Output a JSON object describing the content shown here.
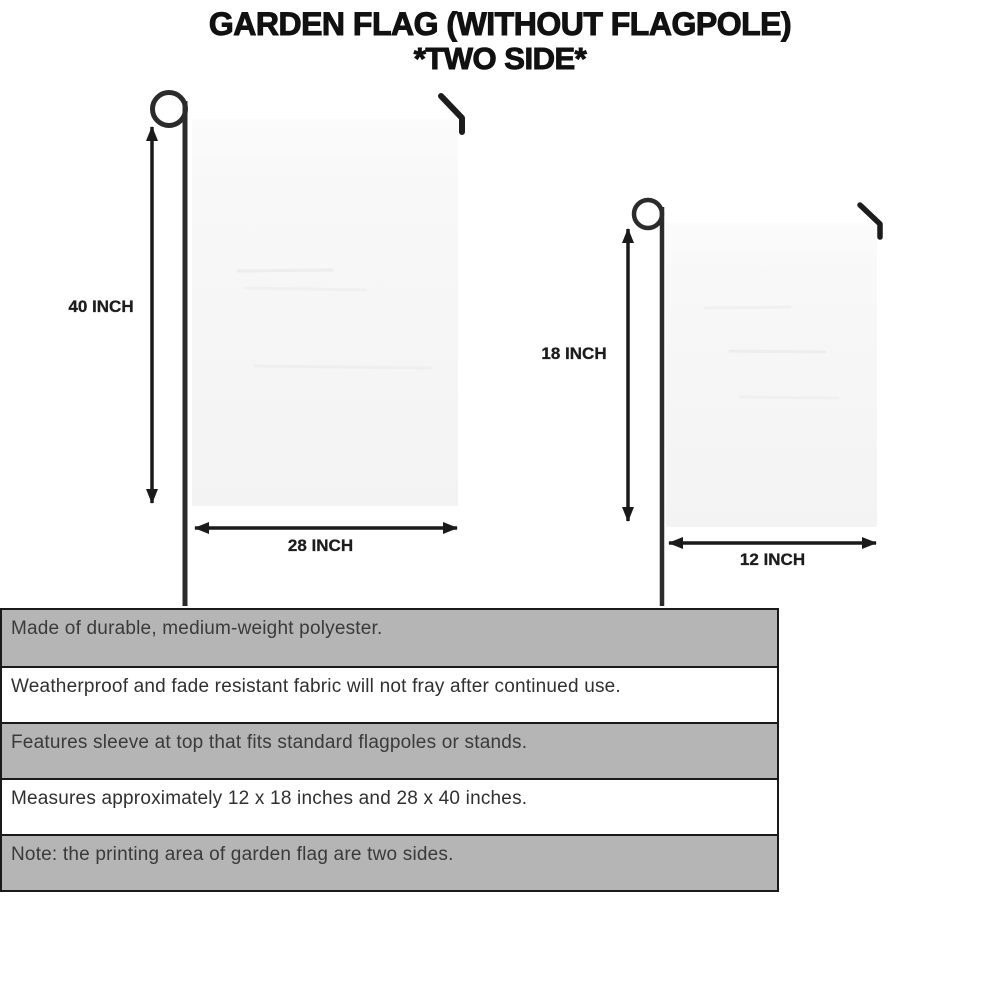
{
  "title": {
    "line1": "GARDEN FLAG (WITHOUT FLAGPOLE)",
    "line2": "*TWO SIDE*"
  },
  "diagram_large": {
    "height_label": "40 INCH",
    "width_label": "28 INCH"
  },
  "diagram_small": {
    "height_label": "18 INCH",
    "width_label": "12 INCH"
  },
  "features": [
    "Made of durable, medium-weight polyester.",
    "Weatherproof and fade resistant fabric will not fray after continued use.",
    "Features sleeve at top that fits standard flagpoles or stands.",
    "Measures approximately 12 x 18 inches and 28 x 40 inches.",
    "Note: the printing area of garden flag are two sides."
  ],
  "colors": {
    "page_bg": "#ffffff",
    "title_color": "#111111",
    "label_color": "#1d1d1d",
    "row_gray": "#b5b5b5",
    "row_white": "#ffffff",
    "border": "#1a1a1a",
    "text": "#3a3a3a",
    "flag_fill": "#f7f7f7",
    "pole_color": "#2b2b2b",
    "arrow_color": "#1a1a1a"
  }
}
